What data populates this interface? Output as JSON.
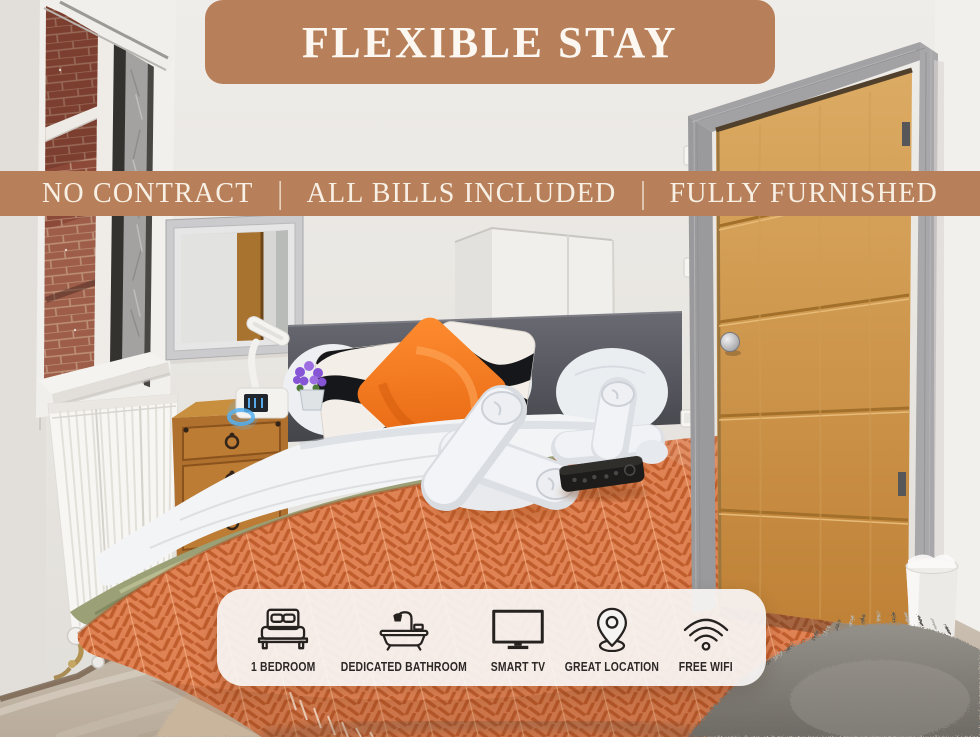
{
  "banner": {
    "title": "FLEXIBLE STAY"
  },
  "ribbon": {
    "items": [
      "NO CONTRACT",
      "ALL BILLS INCLUDED",
      "FULLY FURNISHED"
    ],
    "separator": "|"
  },
  "features": [
    {
      "icon": "bed-icon",
      "label": "1 BEDROOM"
    },
    {
      "icon": "bathtub-icon",
      "label": "DEDICATED BATHROOM"
    },
    {
      "icon": "tv-icon",
      "label": "SMART TV"
    },
    {
      "icon": "location-pin-icon",
      "label": "GREAT LOCATION"
    },
    {
      "icon": "wifi-icon",
      "label": "FREE WIFI"
    }
  ],
  "colors": {
    "accent_tan": "#b7805a",
    "banner_text": "#fcf8f1",
    "pill_background": "#f5f3f1",
    "feature_text": "#2c2825",
    "bedspread_orange": "#df8254",
    "accent_pillow_orange": "#f0781f"
  }
}
